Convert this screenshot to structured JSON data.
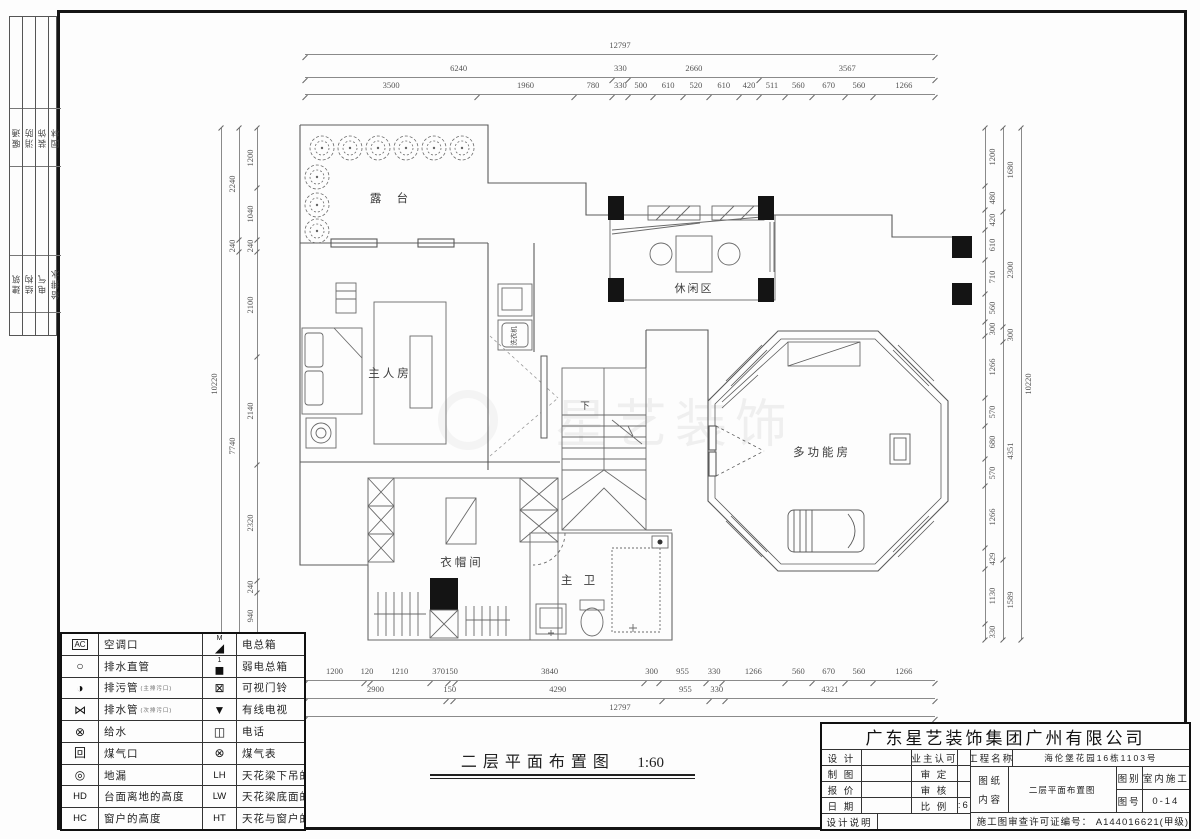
{
  "sign_strip": {
    "top": [
      "暖通",
      "消防",
      "装饰",
      "园林"
    ],
    "bottom": [
      "建筑",
      "结构",
      "电气",
      "给排水"
    ]
  },
  "dims": {
    "top": {
      "total": [
        12797
      ],
      "mid": [
        6240,
        330,
        2660,
        3567
      ],
      "detail": [
        3500,
        1960,
        780,
        330,
        500,
        610,
        520,
        610,
        420,
        511,
        560,
        670,
        560,
        1266
      ]
    },
    "bottom": {
      "detail": [
        1200,
        120,
        1210,
        370,
        150,
        3840,
        300,
        955,
        330,
        1266,
        560,
        670,
        560,
        1266
      ],
      "mid": [
        2900,
        150,
        4290,
        955,
        330,
        4321
      ],
      "total": [
        12797
      ]
    },
    "left": {
      "outer": [
        10220
      ],
      "mid": [
        2240,
        240,
        7740
      ],
      "inner": [
        1200,
        1040,
        240,
        2100,
        2140,
        2320,
        240,
        940
      ]
    },
    "right": {
      "inner": [
        1200,
        480,
        420,
        610,
        710,
        560,
        300,
        1266,
        570,
        680,
        570,
        1266,
        429,
        1130,
        330
      ],
      "mid": [
        1680,
        2300,
        300,
        4351,
        1589
      ],
      "outer": [
        10220
      ]
    }
  },
  "rooms": {
    "terrace": "露 台",
    "leisure": "休闲区",
    "master": "主人房",
    "multi": "多功能房",
    "cloak": "衣帽间",
    "bath": "主 卫",
    "down": "下",
    "washer": "洗衣机"
  },
  "watermark": "星艺装饰",
  "plan_title": {
    "text": "二层平面布置图",
    "scale": "1:60"
  },
  "legend": {
    "rows": [
      {
        "s1": "AC",
        "s1box": true,
        "l1": "空调口",
        "s2": "◢",
        "s2sup": "M",
        "l2": "电总箱"
      },
      {
        "s1": "○",
        "l1": "排水直管",
        "s2": "◼",
        "s2sup": "1",
        "l2": "弱电总箱"
      },
      {
        "s1": "◑",
        "l1": "排污管",
        "n1": "(主排污口)",
        "s2": "⊠",
        "l2": "可视门铃"
      },
      {
        "s1": "⋈",
        "l1": "排水管",
        "n1": "(次排污口)",
        "s2": "▼",
        "l2": "有线电视"
      },
      {
        "s1": "⊗",
        "l1": "给水",
        "s2": "◫",
        "l2": "电话"
      },
      {
        "s1": "回",
        "l1": "煤气口",
        "s2": "⊗",
        "l2": "煤气表"
      },
      {
        "s1": "◎",
        "l1": "地漏",
        "s2": "LH",
        "s2txt": true,
        "l2": "天花梁下吊的高度"
      },
      {
        "s1": "HD",
        "s1txt": true,
        "l1": "台面离地的高度",
        "s2": "LW",
        "s2txt": true,
        "l2": "天花梁底面的宽度"
      },
      {
        "s1": "HC",
        "s1txt": true,
        "l1": "窗户的高度",
        "s2": "HT",
        "s2txt": true,
        "l2": "天花与窗户的高度"
      }
    ]
  },
  "title_block": {
    "company": "广东星艺装饰集团广州有限公司",
    "design_label": "设 计",
    "owner_label": "业主认可",
    "draft_label": "制 图",
    "approve_label": "审 定",
    "quote_label": "报 价",
    "check_label": "审 核",
    "date_label": "日 期",
    "scale_label": "比 例",
    "scale_value": "1:60",
    "note_label": "设计说明",
    "project_label": "工程名称",
    "project_value": "海伦堡花园16栋1103号",
    "sheet_label_1": "图 纸",
    "sheet_label_2": "内 容",
    "sheet_value": "二层平面布置图",
    "cat_label": "图别",
    "cat_value": "室内施工",
    "no_label": "图号",
    "no_value": "0-14",
    "license": "施工图审查许可证编号：  A144016621(甲级)"
  }
}
